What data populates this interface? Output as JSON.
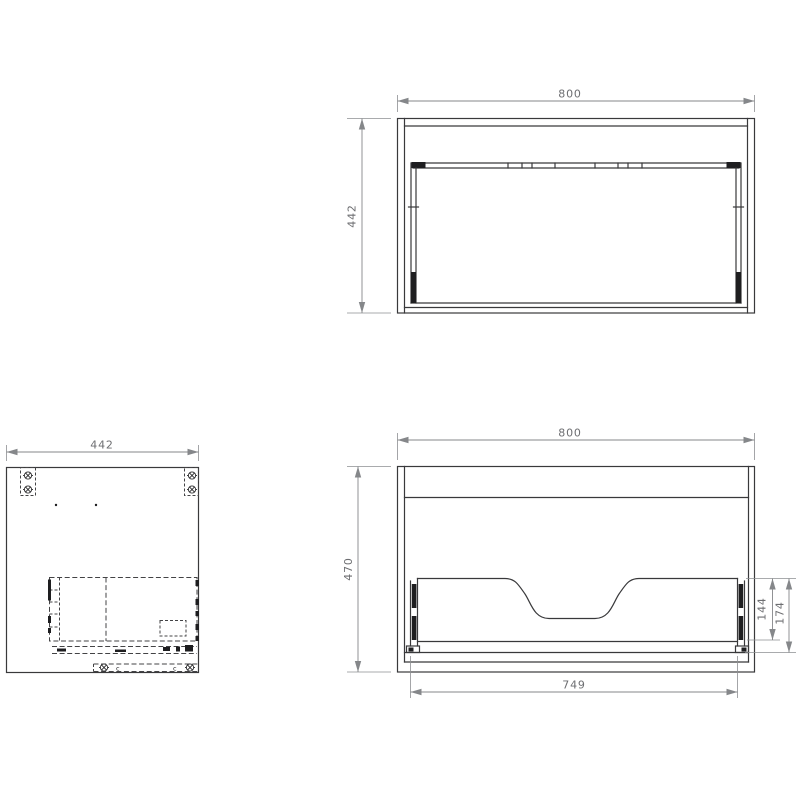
{
  "colors": {
    "background": "#ffffff",
    "drawing_line": "#39393b",
    "hidden_line": "#434345",
    "dimension_line": "#85878a",
    "dimension_text": "#6d6e71"
  },
  "top_view": {
    "width": "800",
    "depth": "442"
  },
  "side_view": {
    "depth": "442",
    "clip_left": "c",
    "clip_right": "c"
  },
  "front_view": {
    "width": "800",
    "height": "470",
    "opening_width": "749",
    "back_cutout_height": "144",
    "drawer_box_height": "174"
  }
}
